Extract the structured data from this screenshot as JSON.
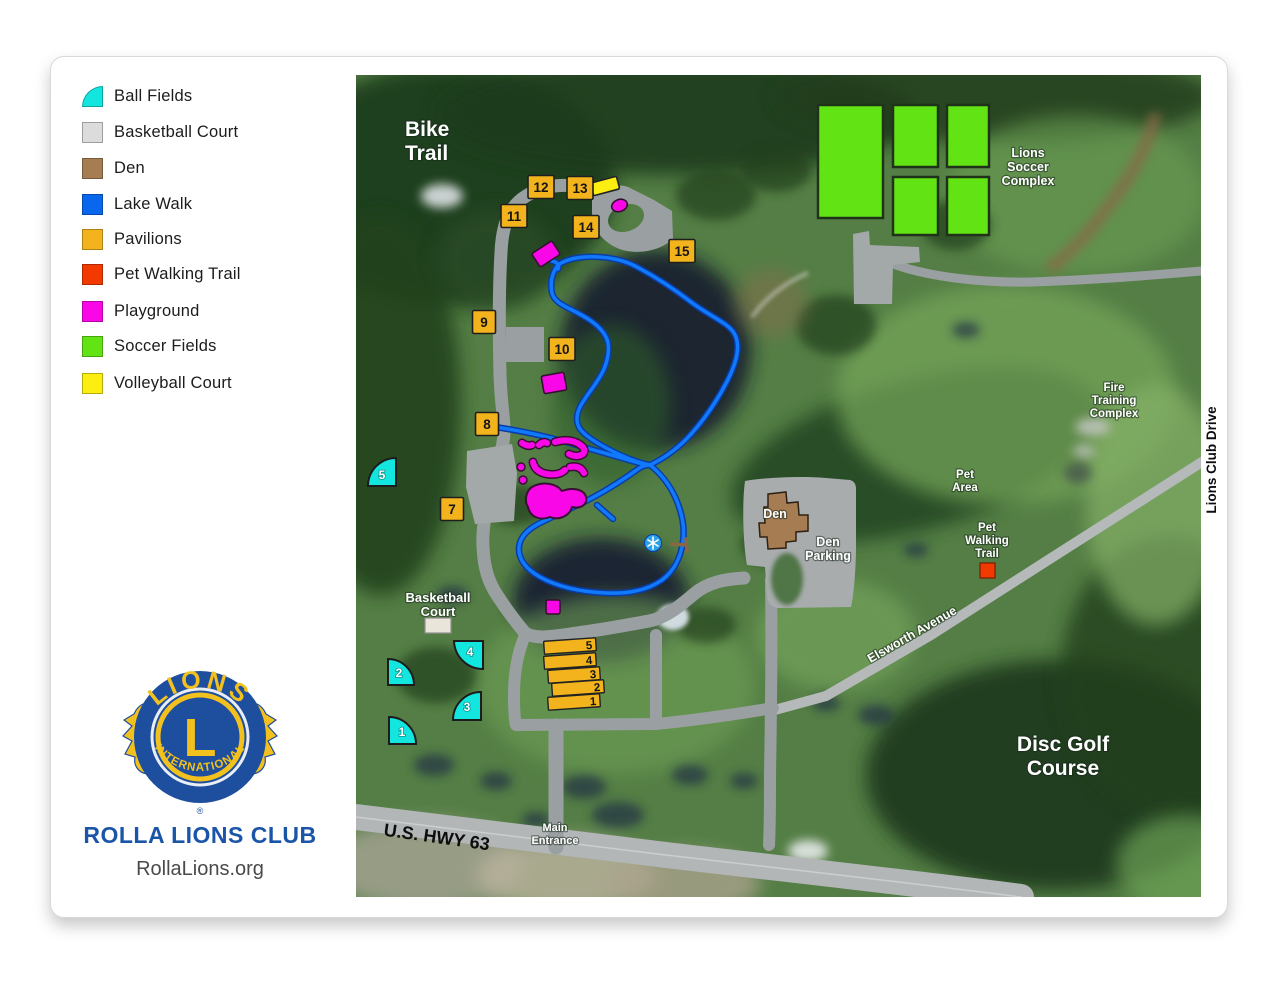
{
  "legend": {
    "items": [
      {
        "label": "Ball Fields",
        "color": "#13e6df"
      },
      {
        "label": "Basketball Court",
        "color": "#dcdcdc"
      },
      {
        "label": "Den",
        "color": "#a67c52"
      },
      {
        "label": "Lake Walk",
        "color": "#0967ee"
      },
      {
        "label": "Pavilions",
        "color": "#f2b31c"
      },
      {
        "label": "Pet Walking Trail",
        "color": "#f23a00"
      },
      {
        "label": "Playground",
        "color": "#fa07e8"
      },
      {
        "label": "Soccer Fields",
        "color": "#62e414"
      },
      {
        "label": "Volleyball Court",
        "color": "#fdee11"
      }
    ]
  },
  "branding": {
    "logo_top": "LIONS",
    "logo_letter": "L",
    "logo_bottom": "INTERNATIONAL",
    "registered": "®",
    "club_name": "ROLLA LIONS CLUB",
    "website": "RollaLions.org",
    "colors": {
      "blue": "#1e4e9e",
      "gold": "#f2c11e"
    }
  },
  "map": {
    "labels": {
      "bike_trail": [
        "Bike",
        "Trail"
      ],
      "soccer_complex": [
        "Lions",
        "Soccer",
        "Complex"
      ],
      "fire_training": [
        "Fire",
        "Training",
        "Complex"
      ],
      "pet_area": [
        "Pet",
        "Area"
      ],
      "pet_walking_trail": [
        "Pet",
        "Walking",
        "Trail"
      ],
      "den": "Den",
      "den_parking": [
        "Den",
        "Parking"
      ],
      "basketball_court": [
        "Basketball",
        "Court"
      ],
      "elsworth_avenue": "Elsworth Avenue",
      "lions_club_drive": "Lions Club Drive",
      "disc_golf": [
        "Disc Golf",
        "Course"
      ],
      "main_entrance": [
        "Main",
        "Entrance"
      ],
      "highway": "U.S. HWY 63"
    },
    "pavilion_markers": [
      "7",
      "8",
      "9",
      "10",
      "11",
      "12",
      "13",
      "14",
      "15"
    ],
    "pavilion_buildings": [
      "5",
      "4",
      "3",
      "2",
      "1"
    ],
    "ball_fields": [
      "1",
      "2",
      "3",
      "4",
      "5"
    ],
    "colors": {
      "ball_fields": "#13e6df",
      "basketball_court": "#eae5da",
      "den": "#a67c52",
      "lake_walk": "#1179fb",
      "pavilions": "#f2b31c",
      "pet_walking_trail": "#f23a00",
      "playground": "#fa07e8",
      "soccer_fields": "#62e414",
      "volleyball_court": "#fdee11",
      "road": "#9aa0a1",
      "highway": "#b2b6b7"
    }
  }
}
